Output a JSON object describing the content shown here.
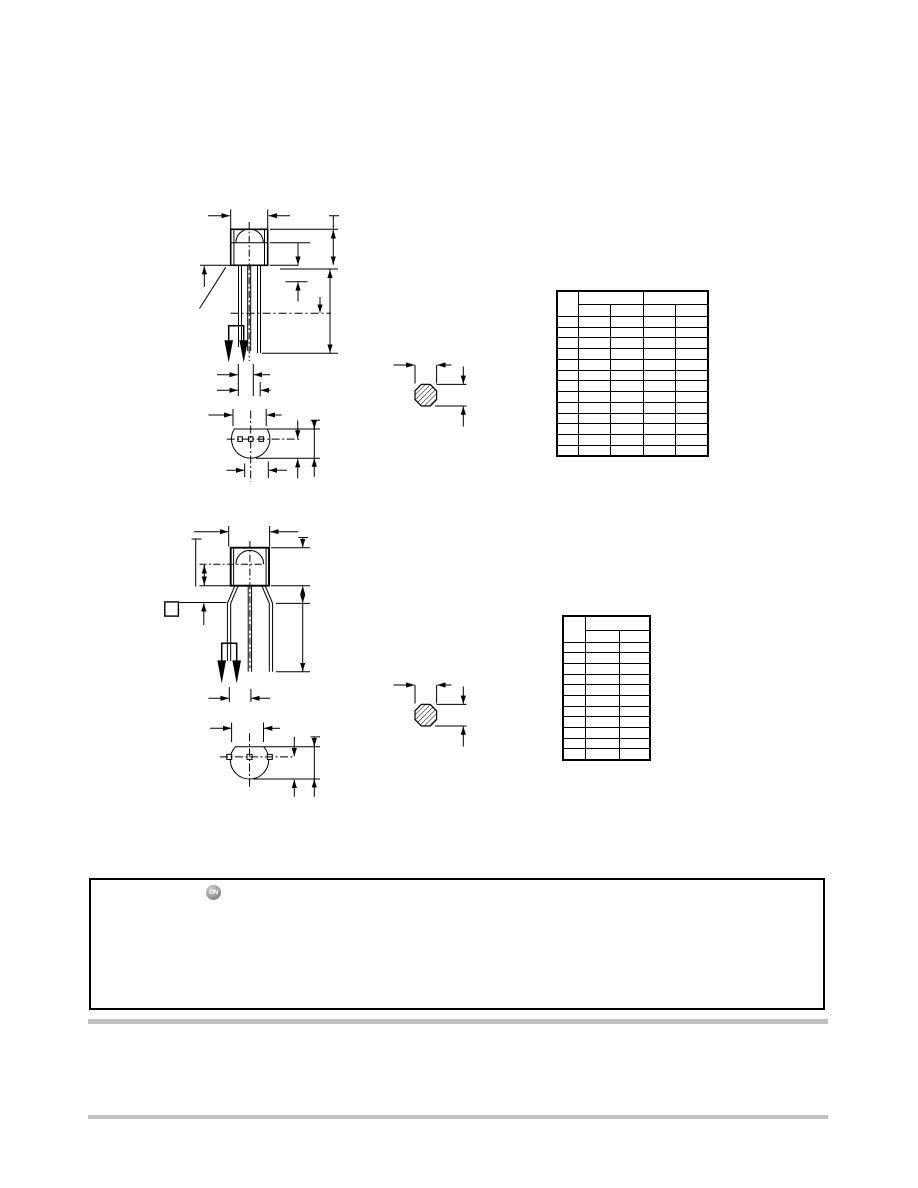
{
  "page": {
    "width": 918,
    "height": 1188,
    "background": "#ffffff",
    "ink": "#000000",
    "rule_color": "#c1c1c1"
  },
  "logo": {
    "text": "ON"
  },
  "figures": {
    "figure1": {
      "name": "package-outline-straight-leads",
      "views": [
        "front",
        "bottom",
        "lead-cross-section"
      ]
    },
    "figure2": {
      "name": "package-outline-formed-leads",
      "views": [
        "front",
        "bottom",
        "lead-cross-section"
      ]
    }
  },
  "tables": [
    {
      "id": "dimension-table-1",
      "x": 556,
      "y": 290,
      "col_widths": [
        21,
        32,
        33,
        32,
        33
      ],
      "header1_h": 13.3,
      "header2_h": 12,
      "rows": 13,
      "row_h": 10.75,
      "header_groups": [
        2,
        2
      ],
      "cell_text": ""
    },
    {
      "id": "dimension-table-2",
      "x": 562,
      "y": 615,
      "col_widths": [
        22,
        34,
        31
      ],
      "header1_h": 14,
      "header2_h": 12,
      "rows": 11,
      "row_h": 10.7,
      "header_groups": [
        2
      ],
      "cell_text": ""
    }
  ],
  "footer_box": {
    "text": ""
  },
  "rules": [
    {
      "y": 1019
    },
    {
      "y": 1114.5
    }
  ]
}
